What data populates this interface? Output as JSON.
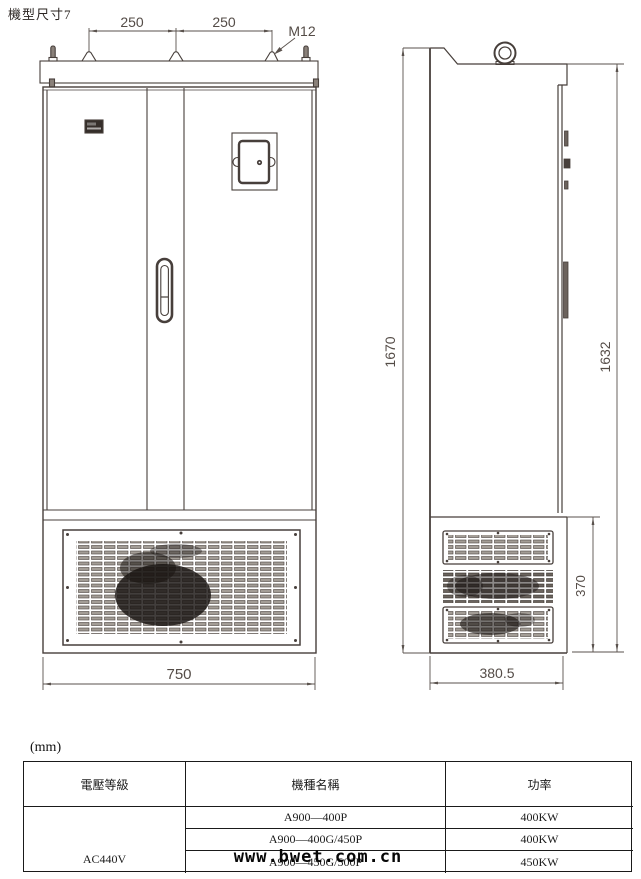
{
  "title": "機型尺寸7",
  "units_label": "(mm)",
  "watermark": "www.bwet.com.cn",
  "drawing": {
    "front_view": {
      "dim_top_left": "250",
      "dim_top_right": "250",
      "bolt_label": "M12",
      "dim_width": "750"
    },
    "side_view": {
      "dim_height_total": "1670",
      "dim_height_door": "1632",
      "dim_plinth_height": "370",
      "dim_depth": "380.5"
    }
  },
  "table": {
    "headers": [
      "電壓等級",
      "機種名稱",
      "功率"
    ],
    "voltage_class": "AC440V",
    "rows": [
      {
        "model": "A900—400P",
        "power": "400KW"
      },
      {
        "model": "A900—400G/450P",
        "power": "400KW"
      },
      {
        "model": "A900—450G/500P",
        "power": "450KW"
      }
    ]
  }
}
